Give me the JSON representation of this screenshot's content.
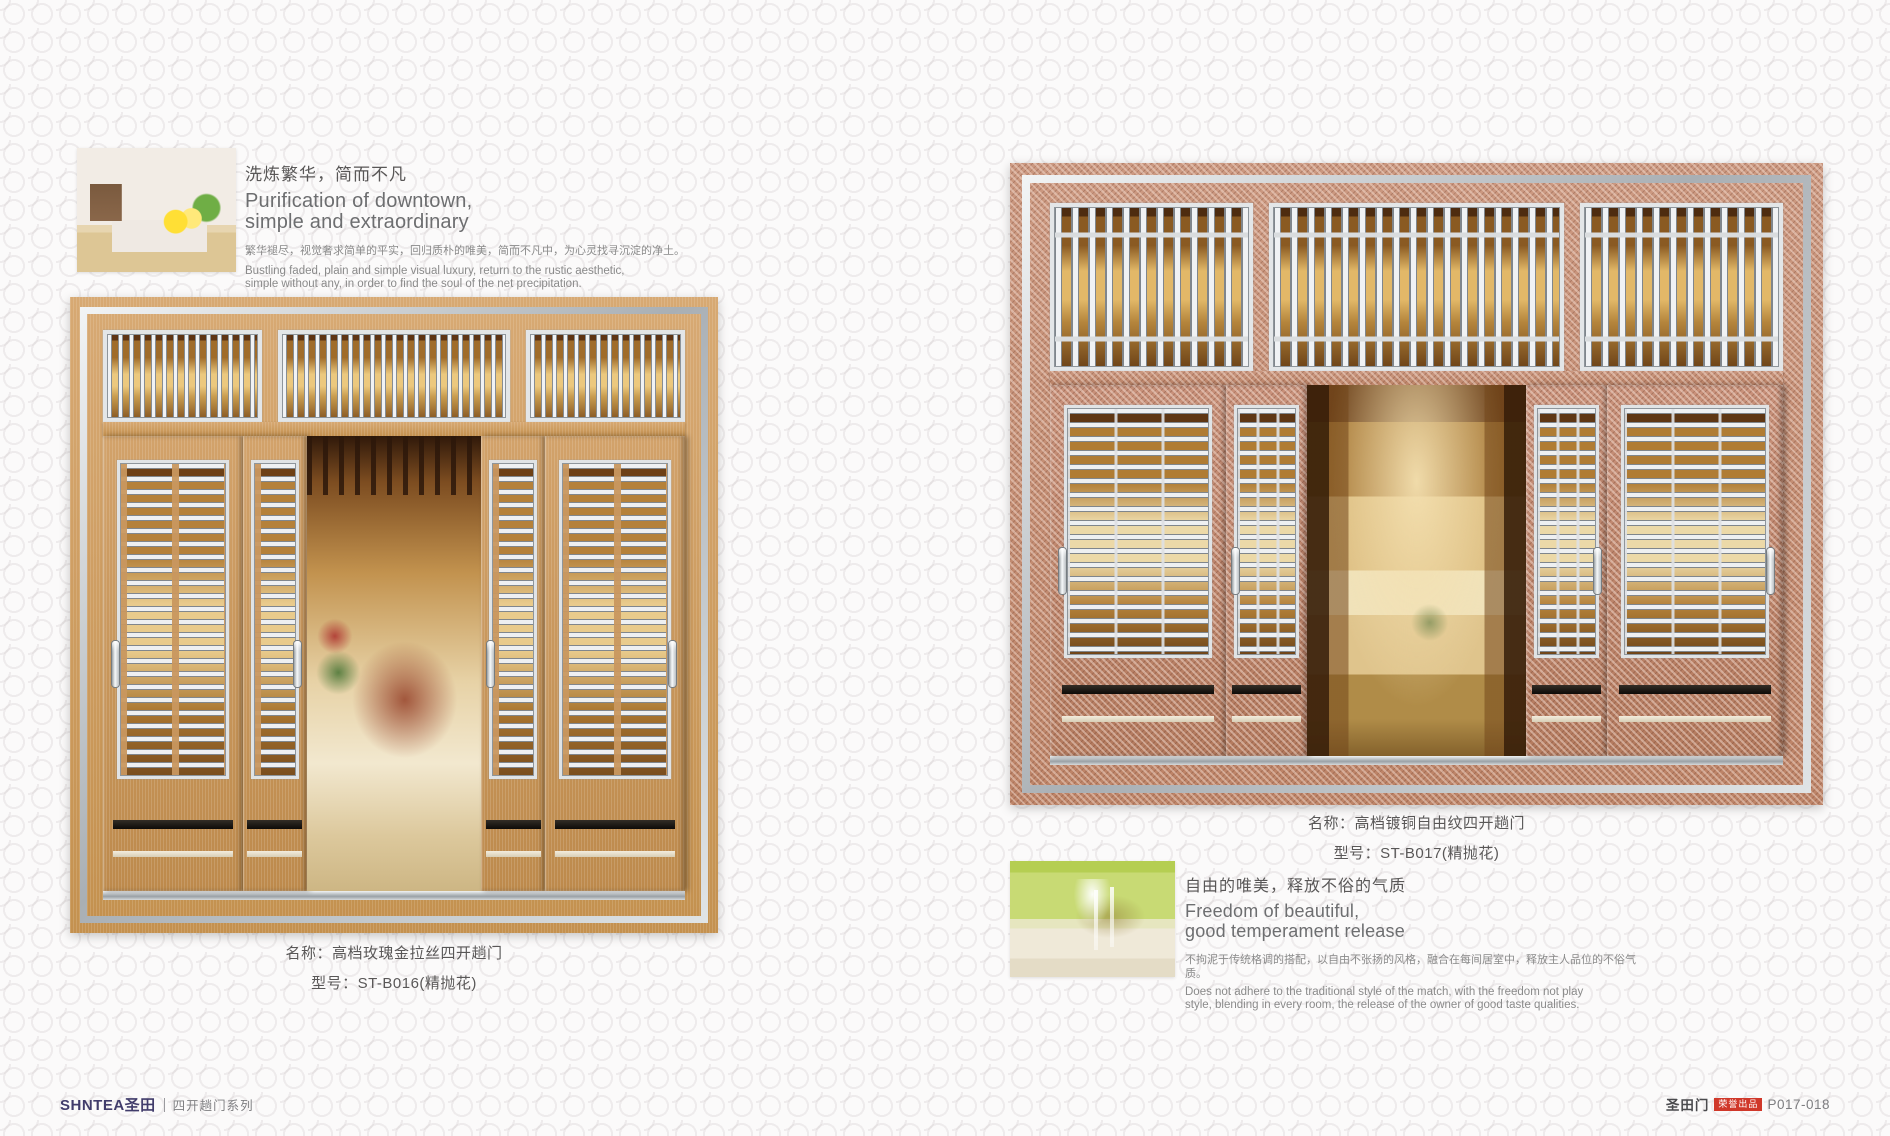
{
  "palette": {
    "page_bg": "#fbfafa",
    "wood": "#c4914f",
    "wood_light": "#d7a973",
    "copper": "#bd8468",
    "silver": "#e6e9eb",
    "navy": "#413c6b",
    "red": "#d0382a",
    "text_dark": "#595757"
  },
  "left_page": {
    "intro": {
      "cn_title": "洗炼繁华，简而不凡",
      "en_title_line1": "Purification of downtown,",
      "en_title_line2": "simple and extraordinary",
      "cn_body": "繁华褪尽，视觉奢求简单的平实，回归质朴的唯美，简而不凡中，为心灵找寻沉淀的净土。",
      "en_body_line1": "Bustling faded, plain and simple visual luxury, return to the rustic aesthetic,",
      "en_body_line2": "simple without any, in order to find the soul of the net precipitation."
    },
    "product": {
      "name_line": "名称：高档玫瑰金拉丝四开趟门",
      "model_line": "型号：ST-B016(精抛花)"
    }
  },
  "right_page": {
    "product": {
      "name_line": "名称：高档镀铜自由纹四开趟门",
      "model_line": "型号：ST-B017(精抛花)"
    },
    "outro": {
      "cn_title": "自由的唯美，释放不俗的气质",
      "en_title_line1": "Freedom of beautiful,",
      "en_title_line2": "good temperament release",
      "cn_body": "不拘泥于传统格调的搭配，以自由不张扬的风格，融合在每间居室中，释放主人品位的不俗气质。",
      "en_body_line1": "Does not adhere to the traditional style of the match, with the freedom not play",
      "en_body_line2": "style, blending in every room, the release of the owner of good taste qualities."
    }
  },
  "footer": {
    "brand_logo": "SHNTEA圣田",
    "series": "四开趟门系列",
    "right_brand": "圣田门",
    "badge": "荣誉出品",
    "page_no": "P017-018"
  }
}
